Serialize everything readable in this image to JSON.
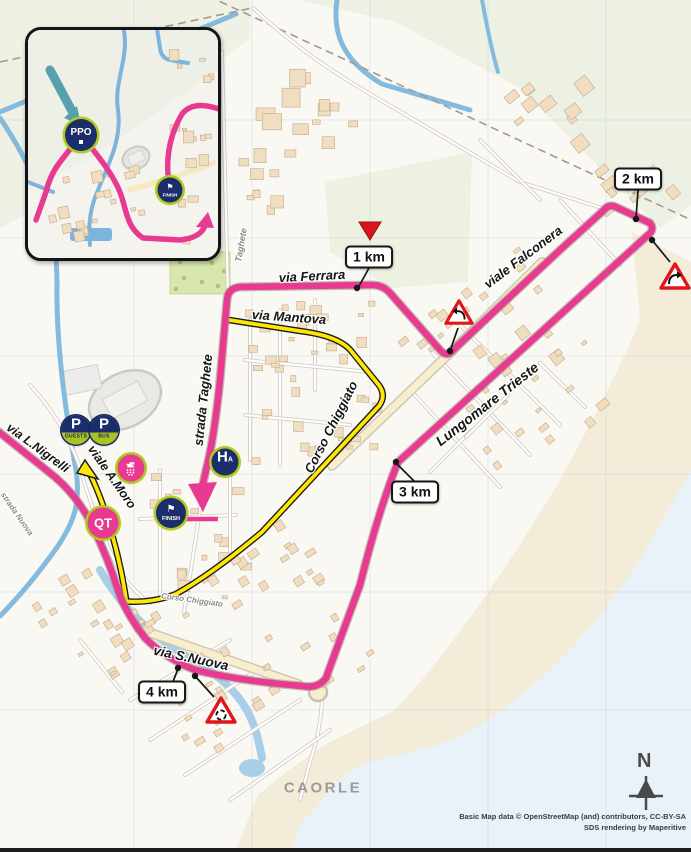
{
  "map": {
    "city_label": "CAORLE",
    "north_label": "N",
    "attribution_line1": "Basic Map data © OpenStreetMap (and) contributors, CC-BY-SA",
    "attribution_line2": "SDS rendering by Maperitive"
  },
  "inset": {
    "ppo_label": "PPO",
    "finish_label": "FINISH",
    "flag": "⚑"
  },
  "markers": {
    "km1": "1 km",
    "km2": "2 km",
    "km3": "3 km",
    "km4": "4 km",
    "finish_label": "FINISH",
    "flag": "⚑",
    "qt_label": "QT",
    "hospital_letter": "H",
    "hospital_sub": "A",
    "parking_letter": "P",
    "parking_guests": "GUESTS",
    "parking_bus": "BUS"
  },
  "streets": {
    "via_ferrara": "via Ferrara",
    "via_mantova": "via Mantova",
    "corso_chiggiato": "Corso Chiggiato",
    "corso_chiggiato_small": "Corso Chiggiato",
    "strada_taghete": "strada Taghete",
    "taghete": "Taghete",
    "viale_falconera": "viale Falconera",
    "lungomare_trieste": "Lungomare Trieste",
    "via_s_nuova": "via S.Nuova",
    "via_l_nigrelli": "via L.Nigrelli",
    "viale_a_moro": "viale A.Moro",
    "strada_nuova": "strada Nuova"
  },
  "colors": {
    "route_pink": "#e73a90",
    "deviation_yellow": "#ffe604",
    "navy": "#1c2d6b",
    "lime": "#b2ca1e",
    "warning_red": "#e0161b",
    "sea": "#e9f2f8",
    "sand": "#f3ecd9"
  }
}
